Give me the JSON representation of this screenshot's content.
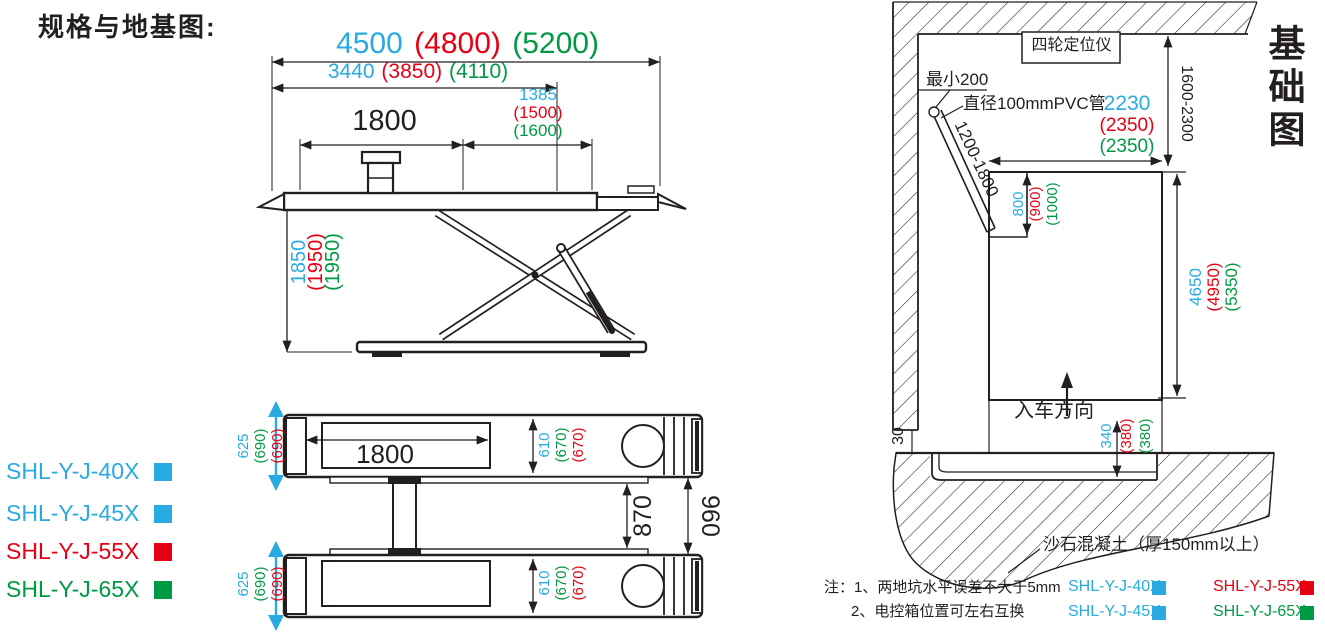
{
  "palette": {
    "blue": "#29abe2",
    "red": "#e60012",
    "green": "#009944",
    "ink": "#231f20"
  },
  "page_title": "规格与地基图:",
  "side_view": {
    "total_length": [
      "4500",
      "(4800)",
      "(5200)"
    ],
    "frame_length": [
      "3440",
      "(3850)",
      "(4110)"
    ],
    "end_offset": [
      "1385",
      "(1500)",
      "(1600)"
    ],
    "platform_length": "1800",
    "raise_height": [
      "1850",
      "(1950)",
      "(1950)"
    ]
  },
  "model_list": [
    {
      "label": "SHL-Y-J-40X",
      "color": "#29abe2"
    },
    {
      "label": "SHL-Y-J-45X",
      "color": "#29abe2"
    },
    {
      "label": "SHL-Y-J-55X",
      "color": "#e60012"
    },
    {
      "label": "SHL-Y-J-65X",
      "color": "#009944"
    }
  ],
  "top_view": {
    "platform_length": "1800",
    "outer_width": [
      "625",
      "(690)",
      "(690)"
    ],
    "tread_width": [
      "610",
      "(670)",
      "(670)"
    ],
    "inner_gap": "870",
    "outer_gap": "960"
  },
  "foundation": {
    "title": "基础图",
    "aligner_box": "四轮定位仪",
    "min_clearance": "最小200",
    "pvc_pipe": "直径100mmPVC管",
    "pipe_length_range": "1200-1800",
    "wall_distance_range": "1600-2300",
    "pit_width": [
      "2230",
      "(2350)",
      "(2350)"
    ],
    "niche_length": [
      "800",
      "(900)",
      "(1000)"
    ],
    "pit_length": [
      "4650",
      "(4950)",
      "(5350)"
    ],
    "pit_depth": [
      "340",
      "(380)",
      "(380)"
    ],
    "edge_step": "30",
    "drive_in": "入车方向",
    "concrete": "沙石混凝土（厚150mm以上）",
    "note1": "注：1、两地坑水平误差不大于5mm",
    "note2": "2、电控箱位置可左右互换",
    "legend": [
      {
        "label": "SHL-Y-J-40X",
        "color": "#29abe2"
      },
      {
        "label": "SHL-Y-J-55X",
        "color": "#e60012"
      },
      {
        "label": "SHL-Y-J-45X",
        "color": "#29abe2"
      },
      {
        "label": "SHL-Y-J-65X",
        "color": "#009944"
      }
    ]
  }
}
